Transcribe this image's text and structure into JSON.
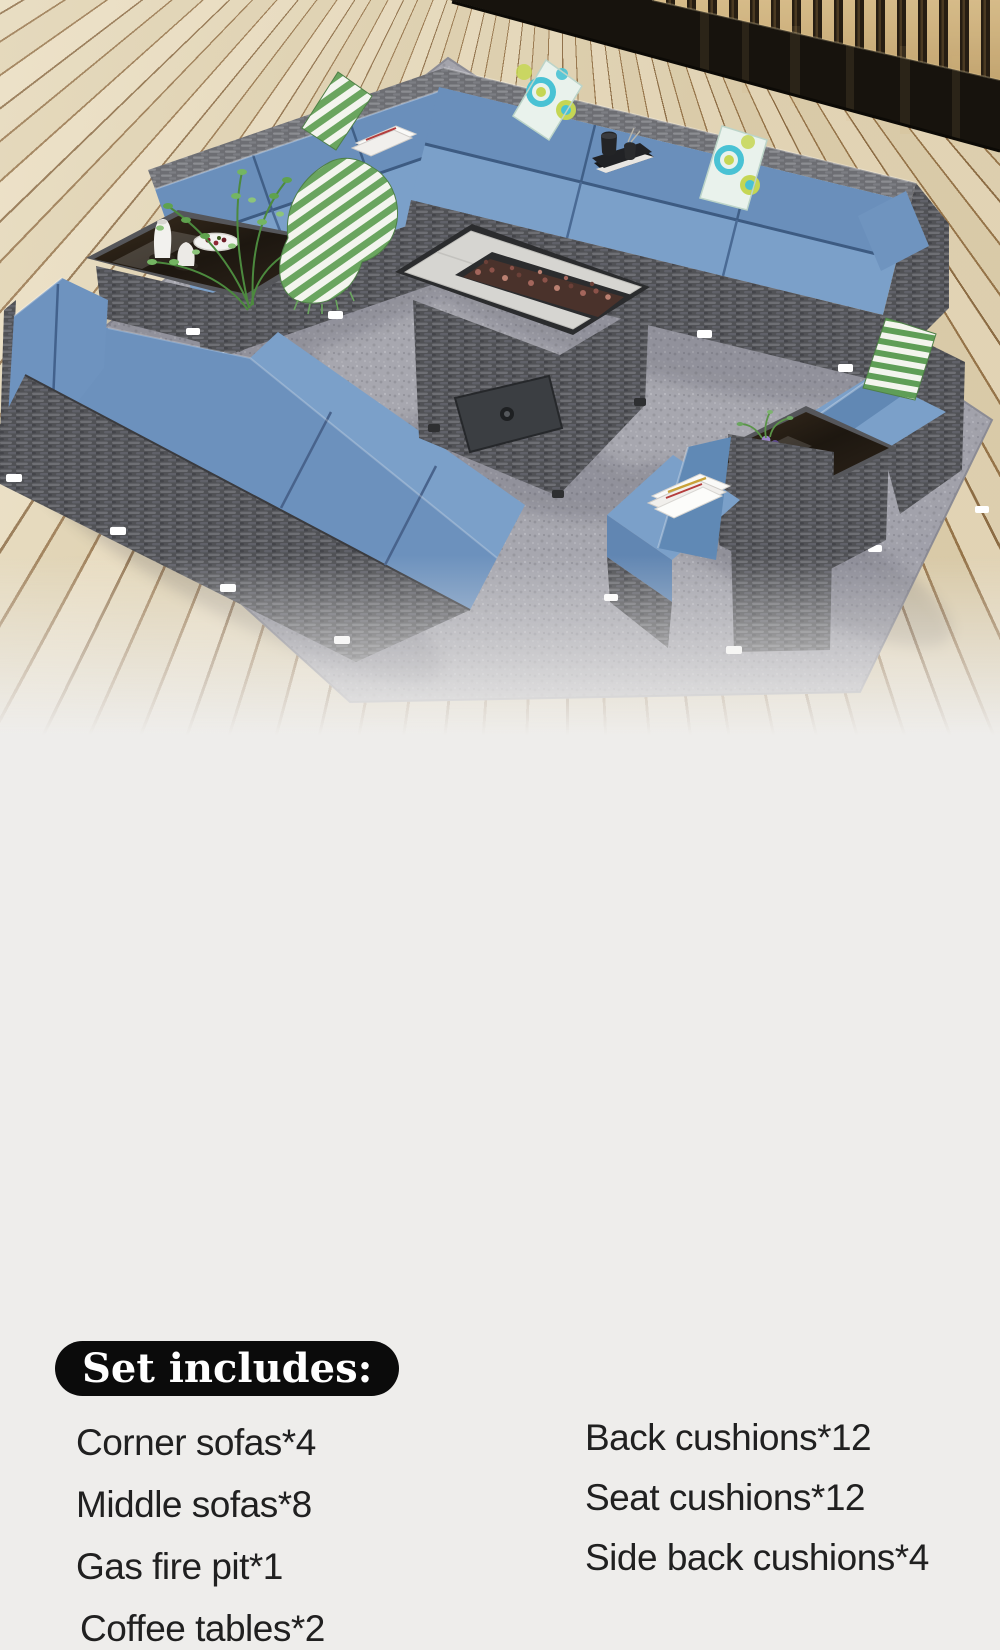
{
  "page": {
    "background": "#eeedeb"
  },
  "colors": {
    "cushion_blue_seat": "#7BA0C9",
    "cushion_blue_back": "#6A8FBB",
    "wicker_gray": "#5B5C60",
    "rug_gray": "#A7A7AF",
    "deck_wood": "#E6D9BA",
    "wall_slat_tan": "#D9B87C",
    "wall_glass_black": "#17130D",
    "pill_background": "#0B0B0B",
    "pill_text": "#FFFFFF",
    "accent_pillow_teal": "#49C2D4",
    "accent_pillow_lime": "#C5D654",
    "accent_stripe_green": "#5F9E57",
    "list_text": "#202020"
  },
  "set_includes": {
    "heading": "Set includes:",
    "left_items": [
      "Corner sofas*4",
      "Middle sofas*8",
      "Gas fire pit*1",
      "Coffee tables*2"
    ],
    "right_items": [
      "Back cushions*12",
      "Seat cushions*12",
      "Side back cushions*4"
    ]
  }
}
